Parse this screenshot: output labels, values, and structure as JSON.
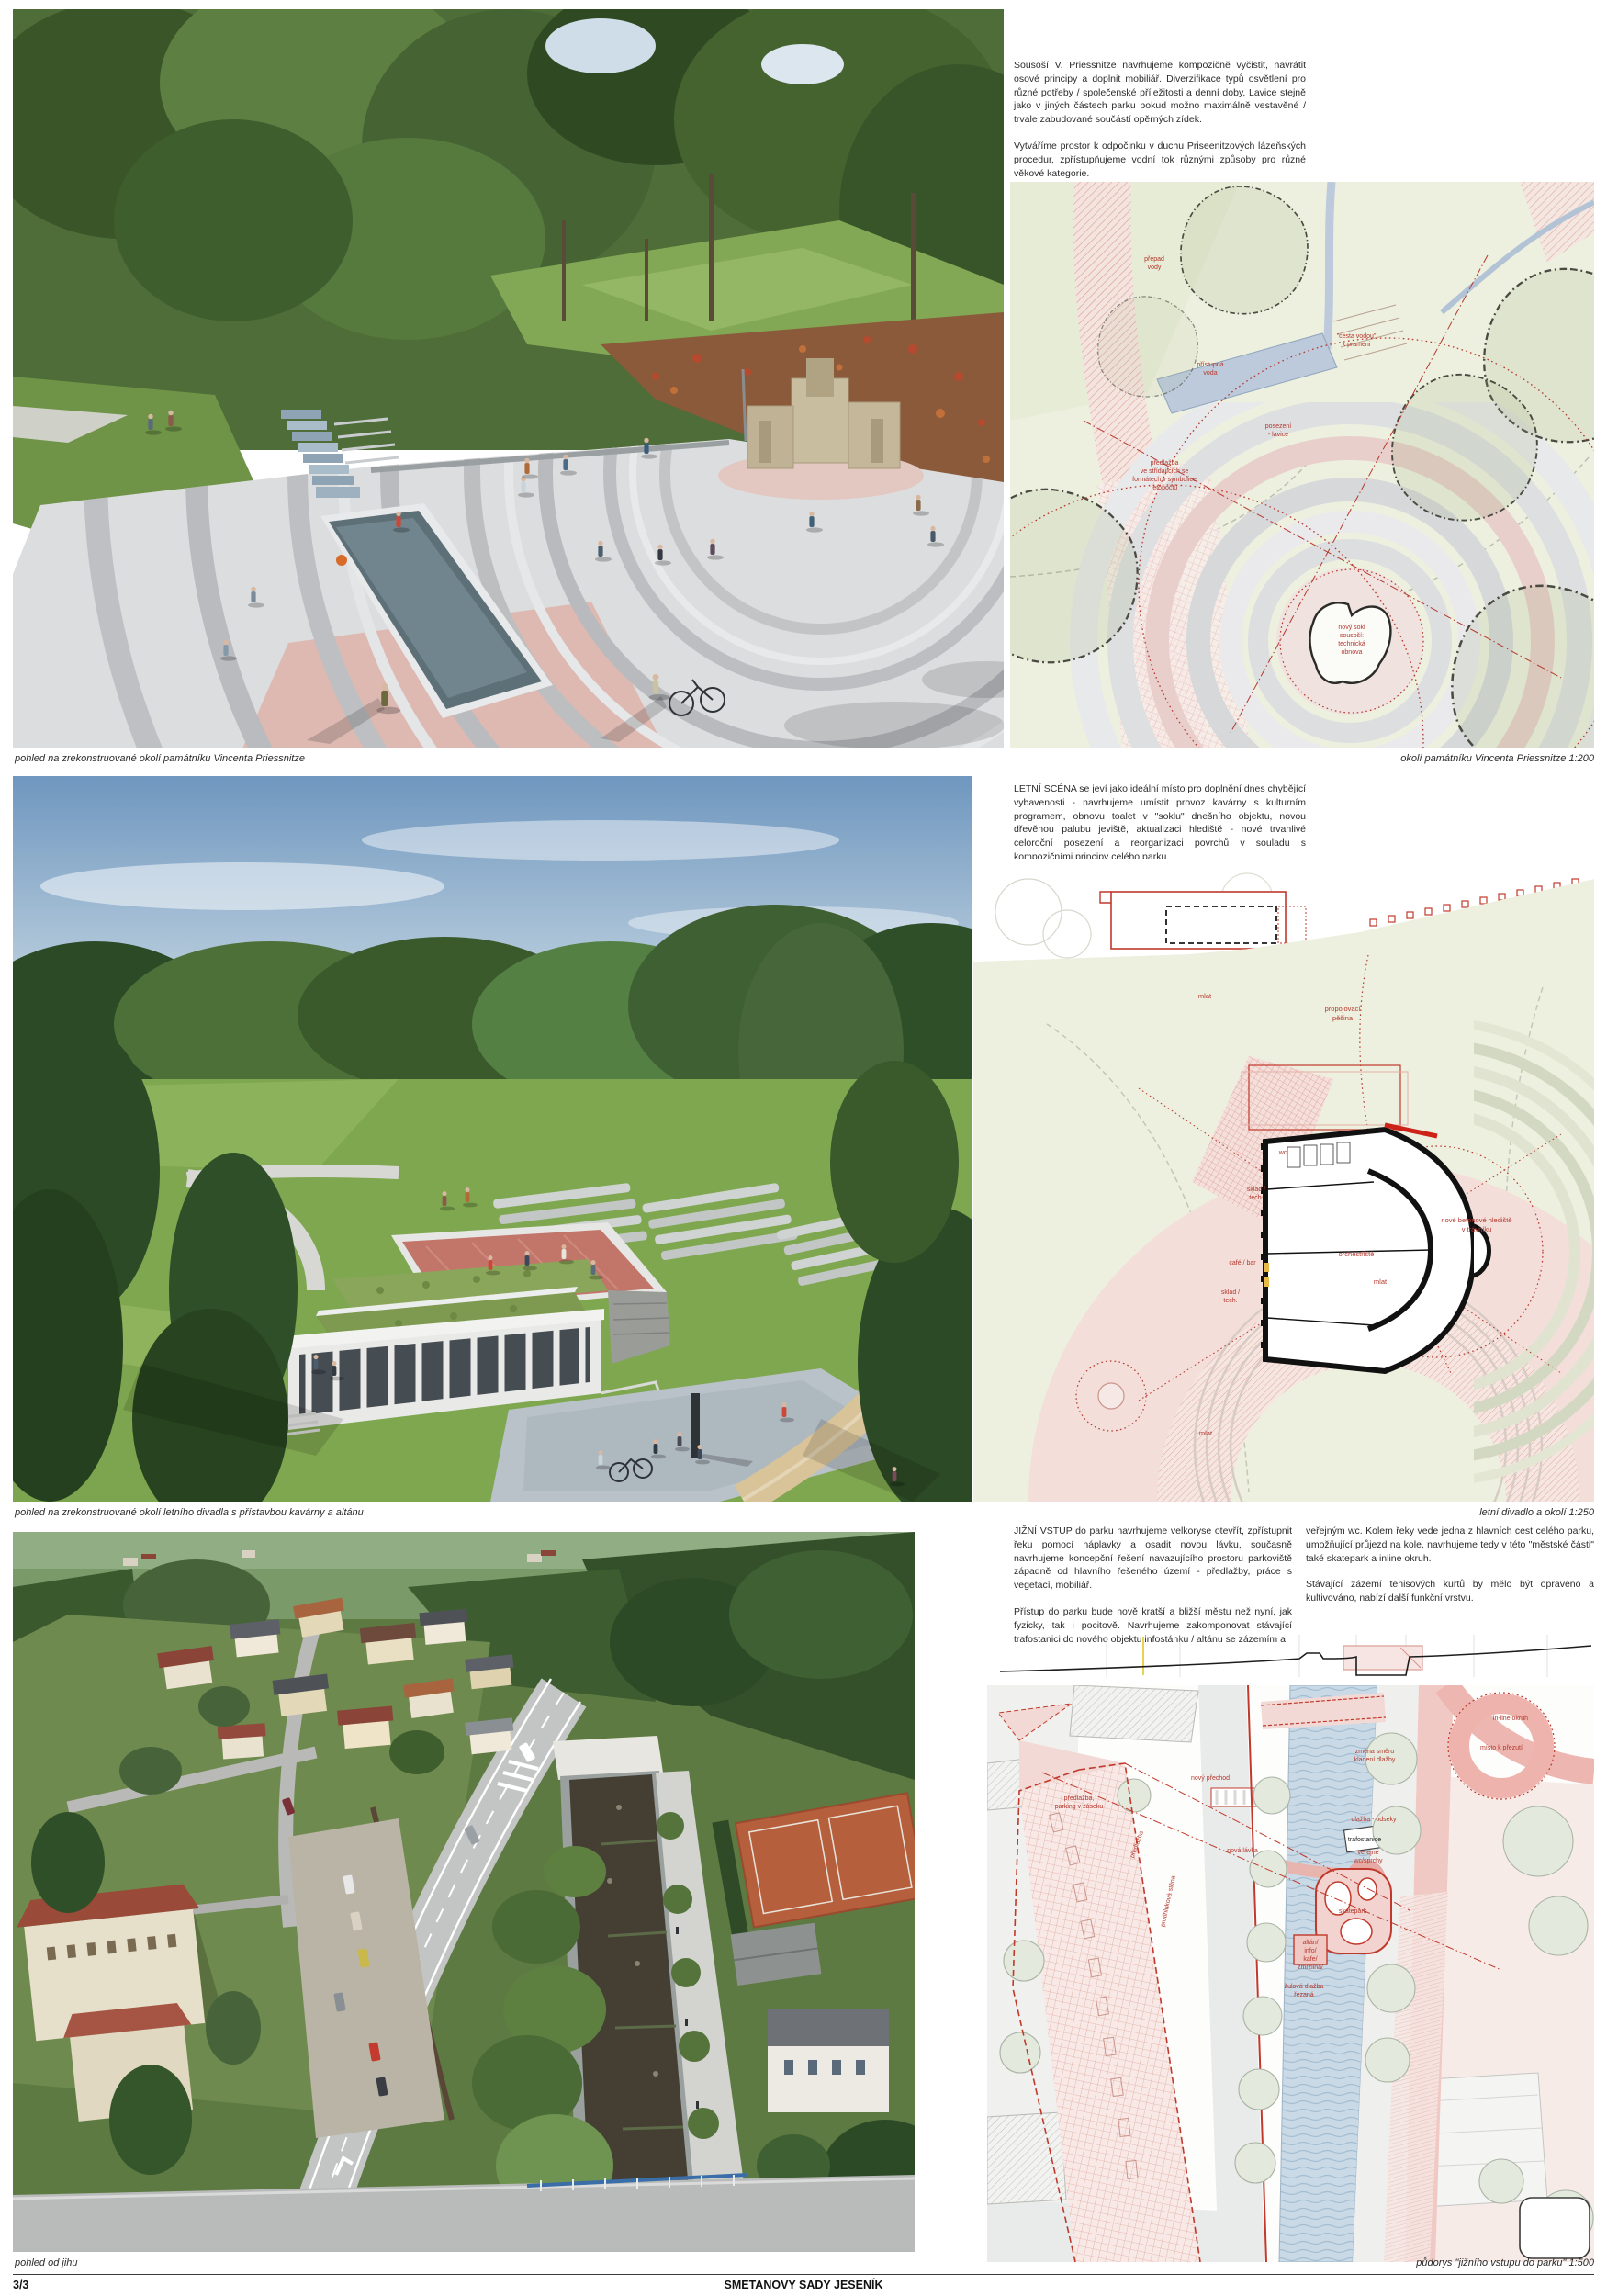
{
  "footer": {
    "page_number": "3/3",
    "title": "SMETANOVY SADY JESENÍK"
  },
  "rows": [
    {
      "paragraphs": [
        "Sousoší V. Priessnitze navrhujeme kompozičně vyčistit, navrátit osové principy a doplnit mobiliář. Diverzifikace typů osvětlení pro různé potřeby / společenské příležitosti a denní doby, Lavice stejně jako v jiných částech parku pokud možno maximálně vestavěné / trvale zabudované součástí opěrných zídek.",
        "Vytváříme prostor k odpočinku v duchu Priseenitzových lázeňských procedur, zpřístupňujeme vodní tok různými způsoby pro různé věkové kategorie."
      ],
      "photo_caption": "pohled na zrekonstruované okolí památníku Vincenta Priessnitze",
      "plan_caption": "okolí památníku Vincenta Priessnitze 1:200",
      "plan_labels": {
        "prepad": [
          "přepad",
          "vody"
        ],
        "cesta": [
          "\"cesta vodou\"",
          "k prameni"
        ],
        "pristupna": [
          "přístupná",
          "voda"
        ],
        "posezeni": [
          "posezení",
          "- lavice"
        ],
        "predlazba": [
          "předlažba",
          "ve střídajících se",
          "formátech v symbolice",
          "letopočtů"
        ],
        "sokl": [
          "nový sokl",
          "sousoší:",
          "technická",
          "obnova"
        ]
      }
    },
    {
      "paragraphs": [
        "LETNÍ SCÉNA se jeví jako ideální místo pro doplnění dnes chybějící vybavenosti - navrhujeme umístit provoz kavárny s kulturním programem, obnovu toalet v \"soklu\" dnešního objektu, novou dřevěnou palubu jeviště, aktualizaci hlediště - nové trvanlivé celoroční posezení a reorganizaci povrchů v souladu s kompozičními principy celého parku."
      ],
      "photo_caption": "pohled na zrekonstruované okolí letního divadla s přístavbou kavárny a altánu",
      "plan_caption": "letní divadlo a okolí 1:250",
      "plan_labels": {
        "mlat1": "mlat",
        "pesina": [
          "propojovací",
          "pěšina"
        ],
        "wc": "wc",
        "sklad1": [
          "sklad /",
          "tech."
        ],
        "cafe": "café / bar",
        "sklad2": [
          "sklad /",
          "tech."
        ],
        "orchestriste": "orchestřiště",
        "mlat2": "mlat",
        "hlediste": [
          "nové betonové hlediště",
          "v trávníku"
        ],
        "mlat3": "mlat"
      }
    },
    {
      "col1": [
        "JIŽNÍ VSTUP do parku navrhujeme velkoryse otevřít, zpřístupnit řeku pomocí náplavky a osadit novou lávku, současně navrhujeme koncepční řešení navazujícího prostoru parkoviště západně od hlavního řešeného území - předlažby, práce s vegetací, mobiliář.",
        "Přístup do parku bude nově kratší a bližší městu než nyní, jak fyzicky, tak i pocitově. Navrhujeme zakomponovat stávající trafostanici do nového objektu infostánku / altánu se zázemím a"
      ],
      "col2": [
        "veřejným wc. Kolem řeky vede jedna z hlavních cest celého parku, umožňující průjezd na kole, navrhujeme tedy v této \"městské části\" také skatepark a inline okruh.",
        "Stávající zázemí tenisových kurtů by mělo být opraveno a kultivováno, nabízí další funkční vrstvu."
      ],
      "photo_caption": "pohled od jihu",
      "plan_caption": "půdorys \"jižního vstupu do parku\" 1:500",
      "plan_labels": {
        "parking": [
          "předlažba,",
          "parking v záseku"
        ],
        "predlazba": "předlažba",
        "stena": "protihluková stěna",
        "prechod": "nový přechod",
        "lavka": "nová lávka",
        "zmena": [
          "změna směru",
          "kladení dlažby"
        ],
        "inline": "in-line okruh",
        "prezuti": "místo k přezutí",
        "odseky": "dlažba - odseky",
        "trafo": "trafostanice",
        "wc": [
          "veřejné",
          "wc/sprchy"
        ],
        "skatepark": "skatepark",
        "altan": [
          "altán/",
          "info/",
          "kafe/",
          "zmrzlina/"
        ],
        "zulova": [
          "žulová dlažba",
          "řezaná"
        ]
      }
    }
  ]
}
